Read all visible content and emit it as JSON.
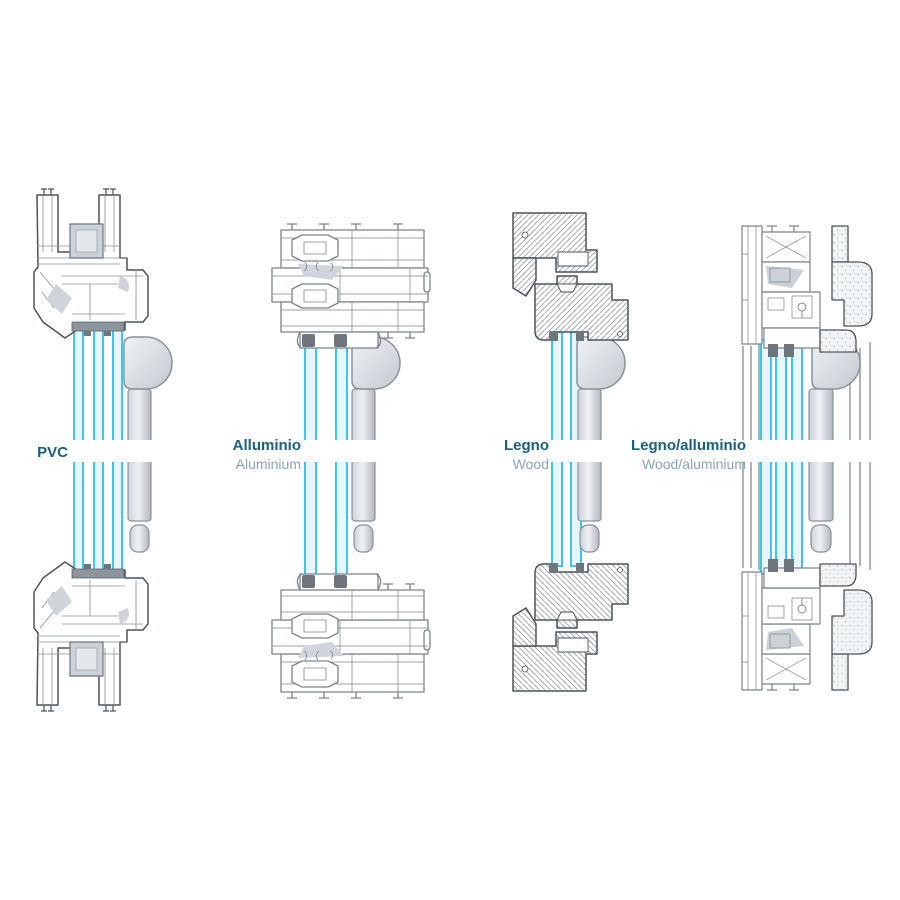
{
  "figure": {
    "kind": "window-frame-cross-sections",
    "orientation": "vertical sections, top and bottom frame with glazing between",
    "colors": {
      "glazing_edge": "#3fc4ec",
      "glazing_fill": "#e7f6fc",
      "outline": "#4d545c",
      "aluminium_line": "#7d848d",
      "handle_fill": "#dfe3e8",
      "label": "#17607f",
      "sublabel": "#8aa6b6"
    },
    "panels": [
      {
        "label": "PVC",
        "sublabel": "",
        "material": "pvc",
        "glazing_panes": 3
      },
      {
        "label": "Alluminio",
        "sublabel": "Aluminium",
        "material": "aluminium",
        "glazing_panes": 2
      },
      {
        "label": "Legno",
        "sublabel": "Wood",
        "material": "wood",
        "glazing_panes": 2
      },
      {
        "label": "Legno/alluminio",
        "sublabel": "Wood/aluminium",
        "material": "wood-aluminium",
        "glazing_panes": 3
      }
    ]
  }
}
